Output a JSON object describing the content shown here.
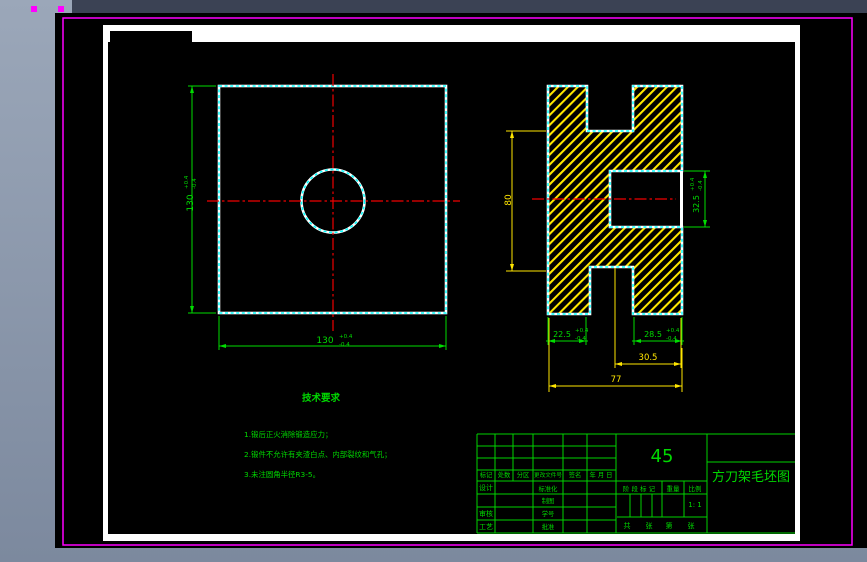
{
  "colors": {
    "background_top": "#9ba7b9",
    "background_bottom": "#7c899e",
    "top_strip": "#3b4254",
    "canvas": "#000000",
    "selection_magenta": "#ff00ff",
    "sheet_border_white": "#ffffff",
    "outline_cyan": "#00ffff",
    "centerline_red": "#f00000",
    "dimension_green": "#00dc00",
    "dimension_yellow": "#ffe600",
    "hatch_yellow": "#ffe600",
    "table_green": "#00d200"
  },
  "plan_view": {
    "width_dim": {
      "v": "130",
      "p": "+0.4",
      "m": "-0.4"
    },
    "height_dim": {
      "v": "130",
      "p": "+0.4",
      "m": "-0.4"
    }
  },
  "section_view": {
    "height_dim": "80",
    "notch_dim": {
      "v": "32.5",
      "p": "+0.4",
      "m": "-0.4"
    },
    "left_leg_dim": {
      "v": "22.5",
      "p": "+0.4",
      "m": "-0.4"
    },
    "right_leg_dim": {
      "v": "28.5",
      "p": "+0.4",
      "m": "-0.4"
    },
    "offset_dim": "30.5",
    "total_width_dim": "77"
  },
  "tech_requirements": {
    "title": "技术要求",
    "items": [
      "1.锻后正火消除锻造应力；",
      "2.锻件不允许有夹渣白点、内部裂纹和气孔；",
      "3.未注圆角半径R3-5。"
    ]
  },
  "title_block": {
    "material": "45",
    "drawing_title": "方刀架毛坯图",
    "revision_header": [
      "标记",
      "处数",
      "分区",
      "更改文件号",
      "签名",
      "年 月 日"
    ],
    "left_labels": [
      "设计",
      "审核",
      "工艺"
    ],
    "mid_labels": [
      "标准化",
      "制图",
      "学号",
      "批准"
    ],
    "stage_mark_label": "阶 段 标 记",
    "weight_label": "重量",
    "scale_label": "比例",
    "scale_value": "1: 1",
    "sheet_words": [
      "共",
      "张",
      "第",
      "张"
    ]
  }
}
